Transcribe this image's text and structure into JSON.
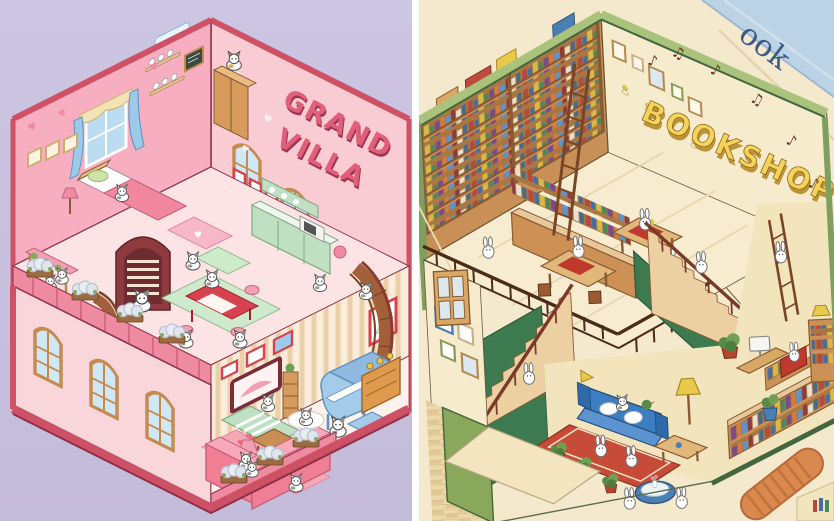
{
  "scene": {
    "description": "Two isometric cutaway miniature-house illustrations side by side: a pink cat villa and a green bookshop"
  },
  "left_panel": {
    "title_line1": "GRAND",
    "title_line2": "VILLA",
    "heart": "♥",
    "colors": {
      "background": "#c8c1de",
      "exterior_wall": "#f9cbd3",
      "interior_wall": "#f6aec0",
      "trim": "#cf5166",
      "accent_blue": "#9ccae9",
      "sofa_pink": "#f07f95",
      "wood": "#c98e54"
    }
  },
  "right_panel": {
    "title": "BOOKSHOP",
    "spine_text": "ook",
    "music_notes": [
      "♪",
      "♫",
      "♪",
      "♫",
      "♪",
      "♪"
    ],
    "colors": {
      "background": "#f4e8cd",
      "frame_green": "#44663e",
      "frame_sage": "#a9c27c",
      "wall_cream": "#f6ebcc",
      "stair_green": "#3e7a50",
      "shelf_wood": "#c89057",
      "title_yellow": "#f6d45c",
      "sofa_blue": "#3d7ec2",
      "rug_red": "#c64b38",
      "spine_blue": "#bcd3e5"
    }
  }
}
